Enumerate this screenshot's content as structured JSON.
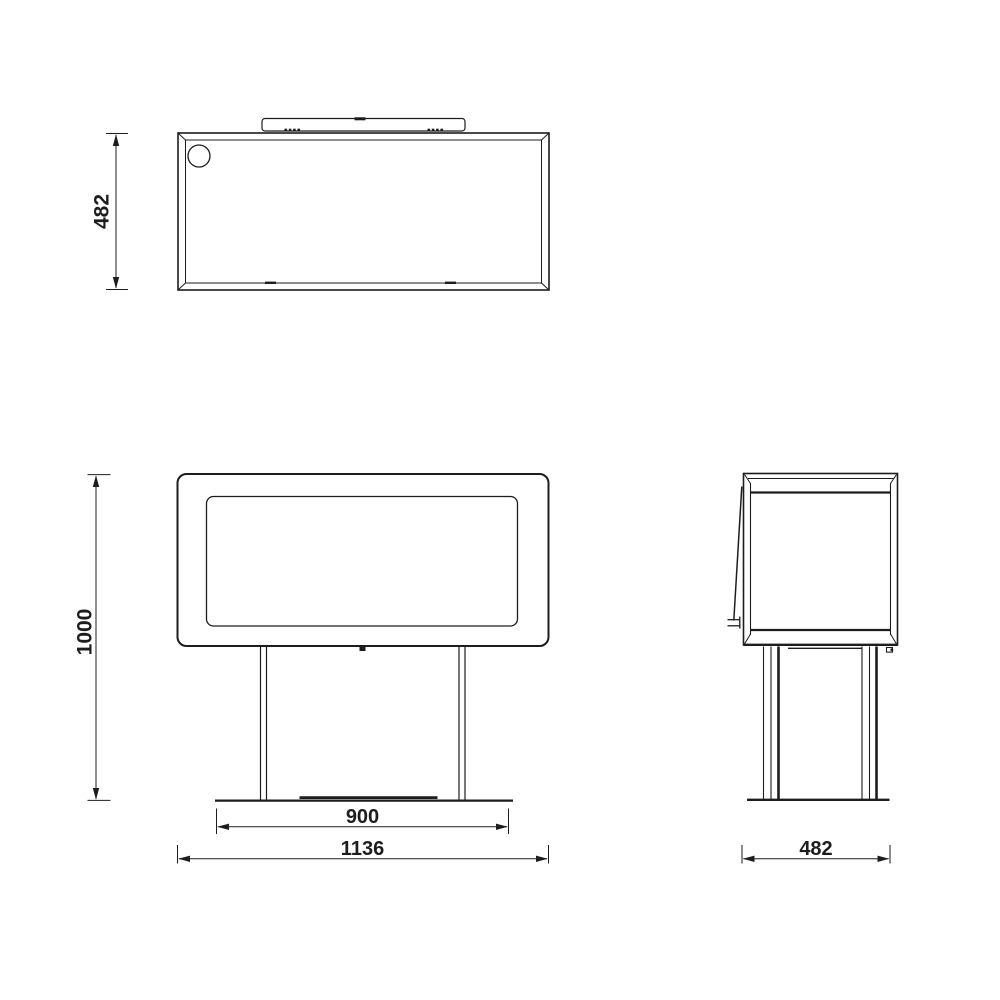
{
  "drawing": {
    "background_color": "#ffffff",
    "line_color": "#1d1d1d",
    "dimensions": {
      "top_view_depth": {
        "value": "482"
      },
      "front_view_height": {
        "value": "1000"
      },
      "front_view_base_width": {
        "value": "900"
      },
      "front_view_total_width": {
        "value": "1136"
      },
      "side_view_depth": {
        "value": "482"
      }
    }
  }
}
